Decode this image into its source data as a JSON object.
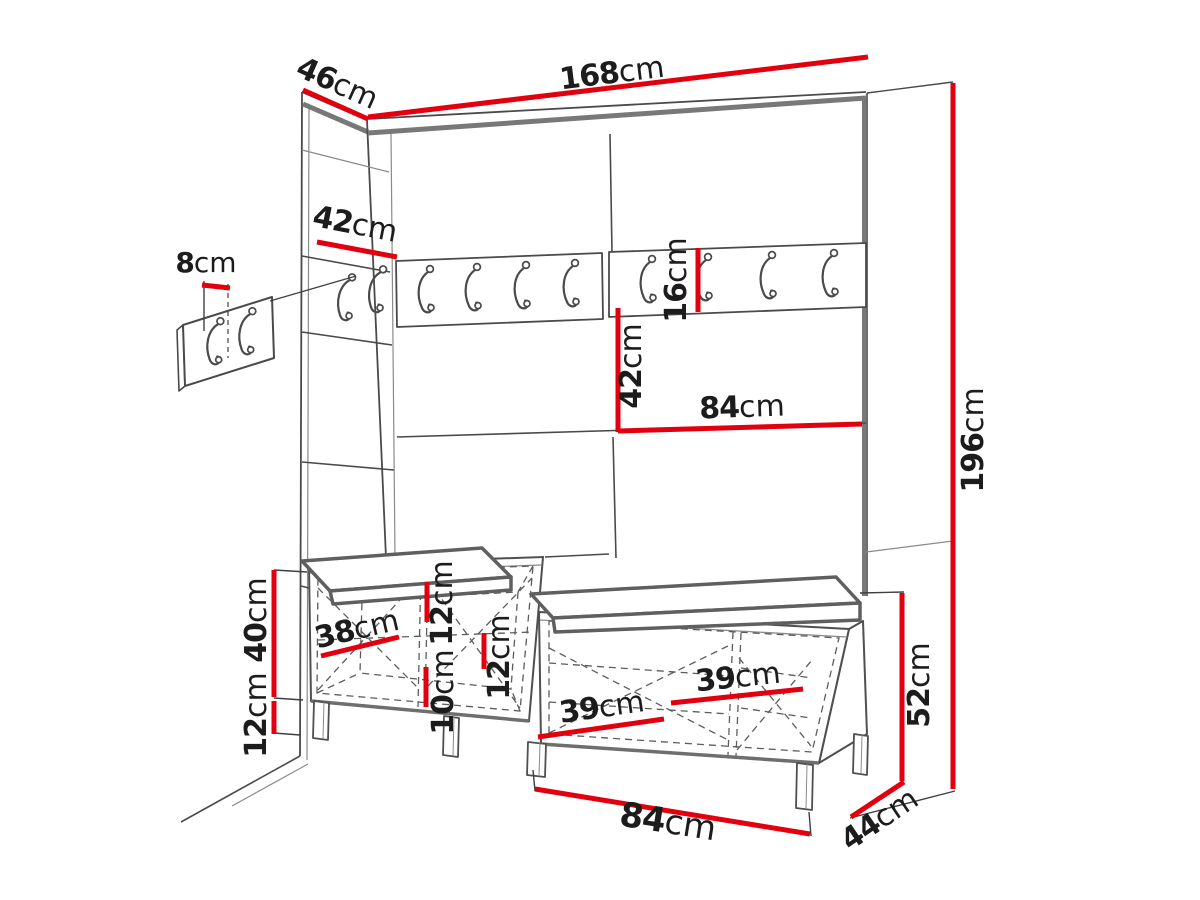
{
  "diagram": {
    "kind": "furniture dimension drawing",
    "accent_color": "#e2000f",
    "line_color": "#4a4a4a",
    "background": "#ffffff"
  },
  "dims": {
    "return_depth_46": {
      "value": "46",
      "unit": "cm"
    },
    "total_width_168": {
      "value": "168",
      "unit": "cm"
    },
    "return_panel_42": {
      "value": "42",
      "unit": "cm"
    },
    "hook_panel_8": {
      "value": "8",
      "unit": "cm"
    },
    "rail_height_16": {
      "value": "16",
      "unit": "cm"
    },
    "panel_height_42": {
      "value": "42",
      "unit": "cm"
    },
    "panel_width_84": {
      "value": "84",
      "unit": "cm"
    },
    "total_height_196": {
      "value": "196",
      "unit": "cm"
    },
    "bench_height_40": {
      "value": "40",
      "unit": "cm"
    },
    "leg_height_12": {
      "value": "12",
      "unit": "cm"
    },
    "bench_inner_38": {
      "value": "38",
      "unit": "cm"
    },
    "clearance_top_12": {
      "value": "12",
      "unit": "cm"
    },
    "clearance_mid_10": {
      "value": "10",
      "unit": "cm"
    },
    "clearance_inner_12": {
      "value": "12",
      "unit": "cm"
    },
    "shelf_width_39_a": {
      "value": "39",
      "unit": "cm"
    },
    "shelf_width_39_b": {
      "value": "39",
      "unit": "cm"
    },
    "bench_total_52": {
      "value": "52",
      "unit": "cm"
    },
    "bench_width_84": {
      "value": "84",
      "unit": "cm"
    },
    "bench_depth_44": {
      "value": "44",
      "unit": "cm"
    }
  }
}
